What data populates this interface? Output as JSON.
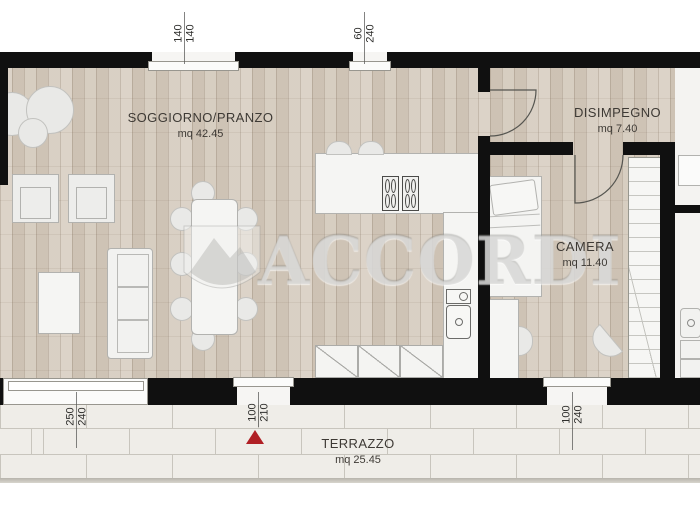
{
  "watermark": {
    "text": "ACCORDI",
    "logo": "mountain-crest"
  },
  "rooms": [
    {
      "id": "soggiorno",
      "name": "SOGGIORNO/PRANZO",
      "area": "mq 42.45"
    },
    {
      "id": "disimpegno",
      "name": "DISIMPEGNO",
      "area": "mq 7.40"
    },
    {
      "id": "camera",
      "name": "CAMERA",
      "area": "mq 11.40"
    },
    {
      "id": "terrazzo",
      "name": "TERRAZZO",
      "area": "mq 25.45"
    }
  ],
  "dimensions": [
    {
      "id": "top-window-large",
      "width": "140",
      "height": "140"
    },
    {
      "id": "top-window-small",
      "width": "60",
      "height": "240"
    },
    {
      "id": "terrace-glass-door",
      "width": "250",
      "height": "240"
    },
    {
      "id": "entrance-door",
      "width": "100",
      "height": "210"
    },
    {
      "id": "camera-window",
      "width": "100",
      "height": "240"
    }
  ],
  "markers": {
    "entrance_arrow_color": "#b01f24"
  },
  "colors": {
    "wall": "#101010",
    "wood_floor": "#d5cbbe",
    "terrace_tile": "#efede8",
    "furniture": "#f2f2f0",
    "watermark": "#d0d0ce"
  }
}
